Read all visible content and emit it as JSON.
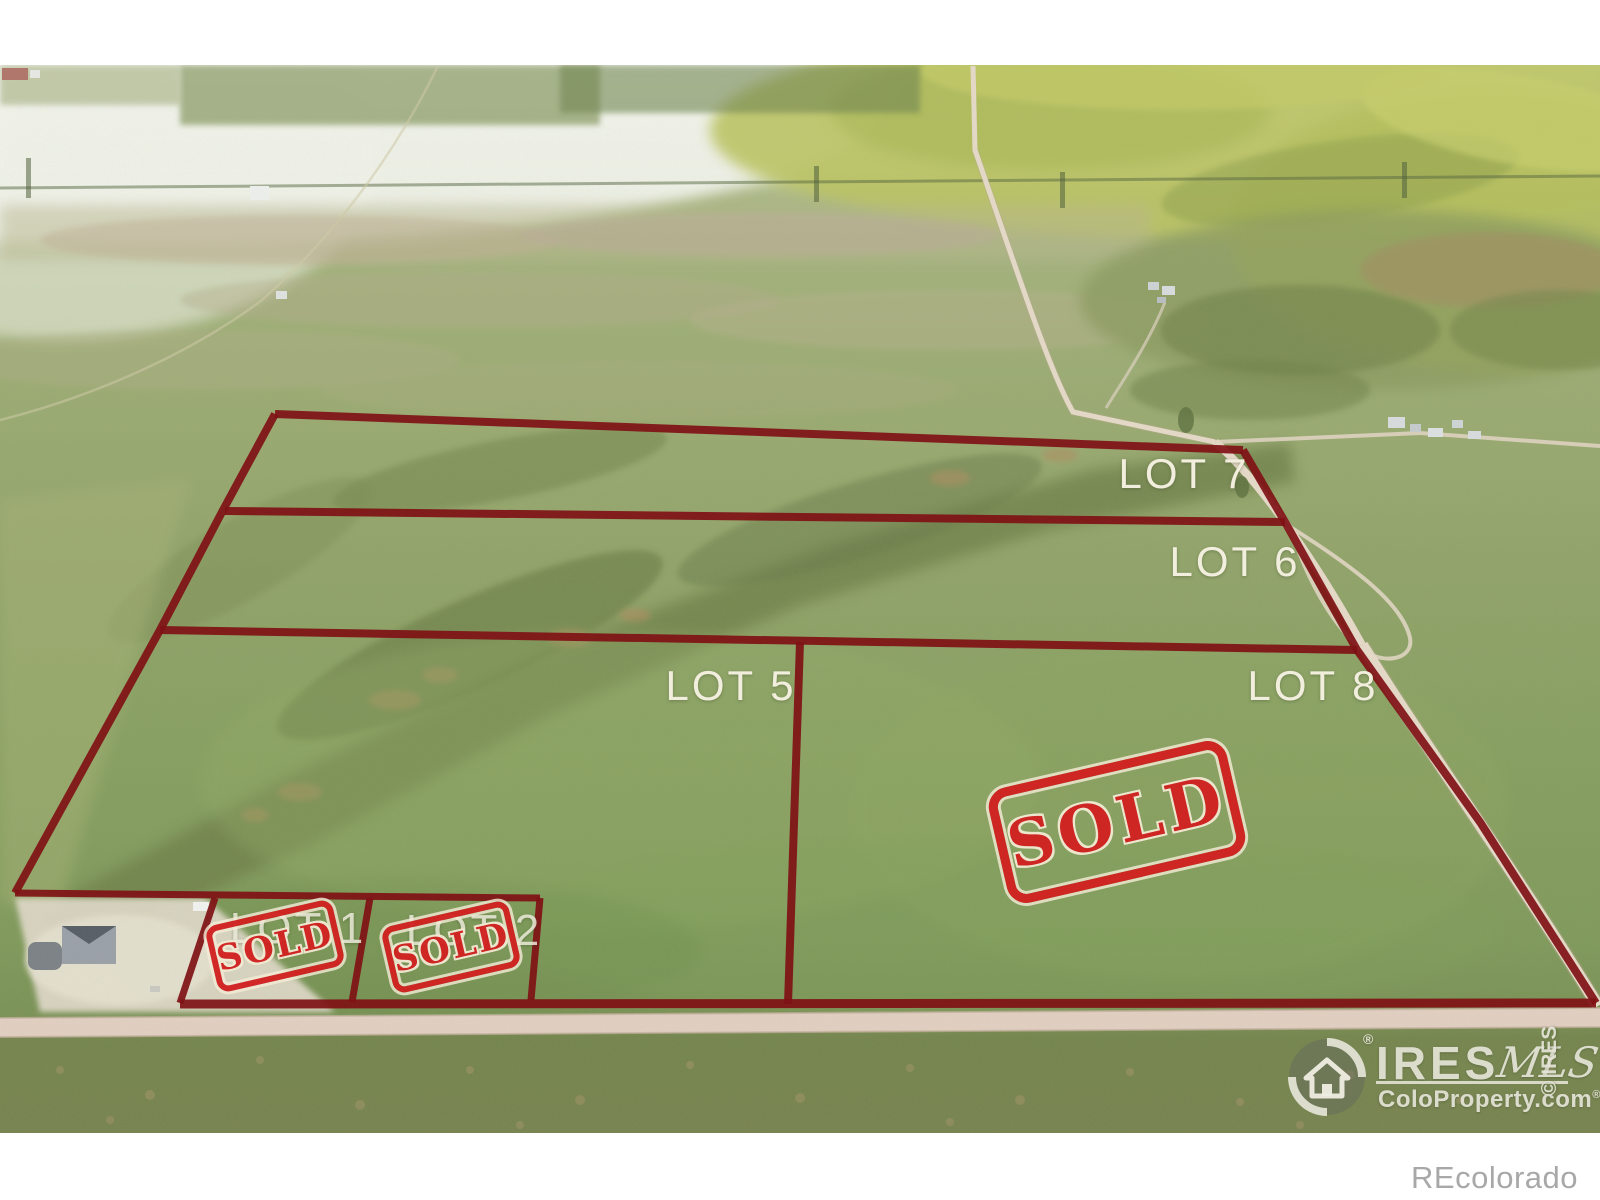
{
  "lots": [
    {
      "id": "lot-1",
      "label": "LOT 1",
      "status": "SOLD"
    },
    {
      "id": "lot-2",
      "label": "LOT 2",
      "status": "SOLD"
    },
    {
      "id": "lot-5",
      "label": "LOT 5",
      "status": ""
    },
    {
      "id": "lot-6",
      "label": "LOT 6",
      "status": ""
    },
    {
      "id": "lot-7",
      "label": "LOT 7",
      "status": ""
    },
    {
      "id": "lot-8",
      "label": "LOT 8",
      "status": "SOLD"
    }
  ],
  "stamp": {
    "text": "SOLD"
  },
  "watermark": {
    "brand": "IRES",
    "brand_reg": "®",
    "mls": "MLS",
    "site": "ColoProperty.com",
    "site_reg": "®",
    "copyright": "© IRES"
  },
  "footer": {
    "brand": "REcolorado"
  },
  "colors": {
    "boundary_red": "#7f1115",
    "stamp_red": "#d12221",
    "label_cream": "#f2eedd",
    "grass_green": "#8aa364",
    "road_tan": "#e6d9c9"
  }
}
